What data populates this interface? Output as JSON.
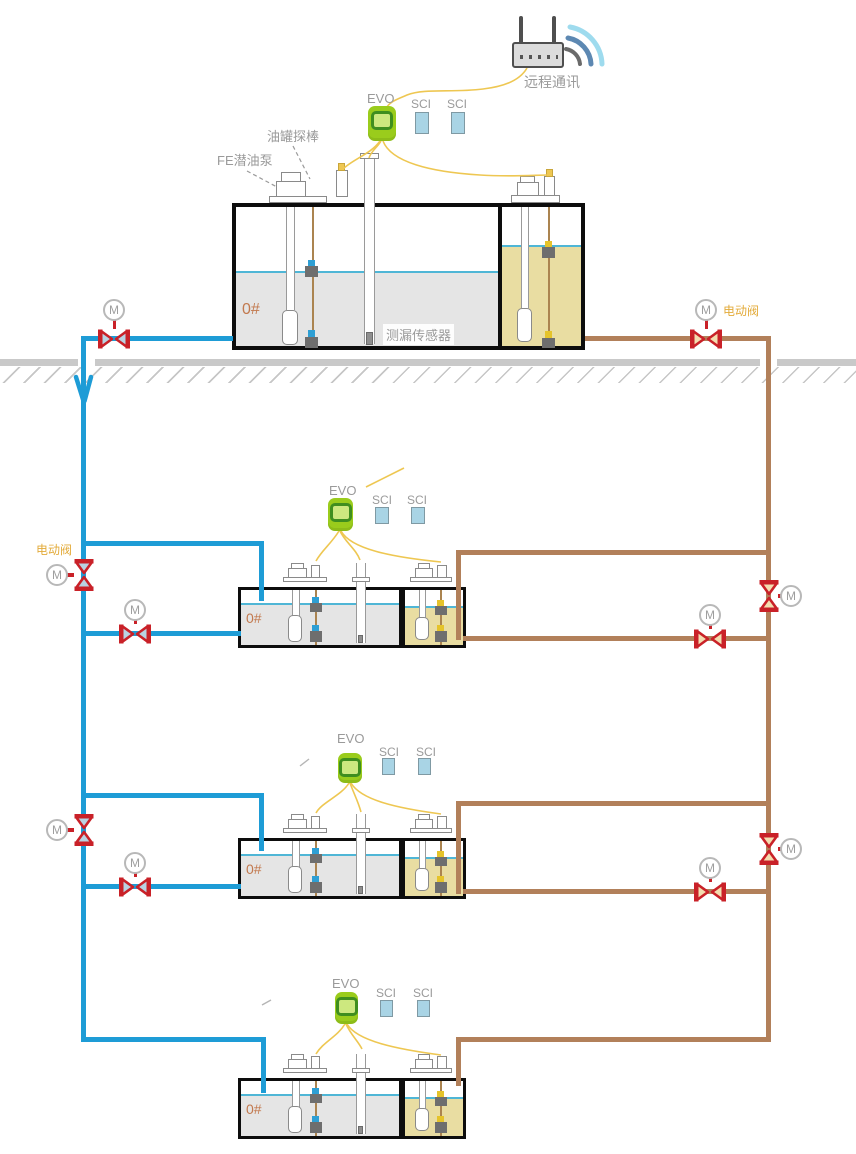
{
  "labels": {
    "remote_comm": "远程通讯",
    "evo": "EVO",
    "sci": "SCI",
    "tank_probe": "油罐探棒",
    "fe_pump": "FE潜油泵",
    "leak_sensor": "测漏传感器",
    "motor_valve": "电动阀",
    "grade": "0#",
    "motor": "M"
  },
  "colors": {
    "pipe_blue": "#1e9cd6",
    "pipe_brown": "#b2805a",
    "valve_red": "#c92128",
    "valve_fill_blue": "#b9d3e2",
    "valve_fill_tan": "#f3ddb0",
    "wire_yellow": "#eec752",
    "liquid_gray": "#e5e5e5",
    "liquid_tan": "#e9dda2",
    "liquid_line": "#4fb6d6",
    "evo_green": "#9acc1c",
    "evo_ring": "#3f8e1f",
    "evo_inner": "#cde87f",
    "sci_blue": "#a9d4e5",
    "ground_gray": "#c9c9c9",
    "label_gray": "#9a9a9a",
    "grade_orange": "#c2794e",
    "valve_label_orange": "#e3ab3a",
    "float_gray": "#6e6e6e",
    "float_blue": "#2e9fd4",
    "float_yellow": "#e5c32a",
    "tank_border": "#0d0d0d"
  }
}
